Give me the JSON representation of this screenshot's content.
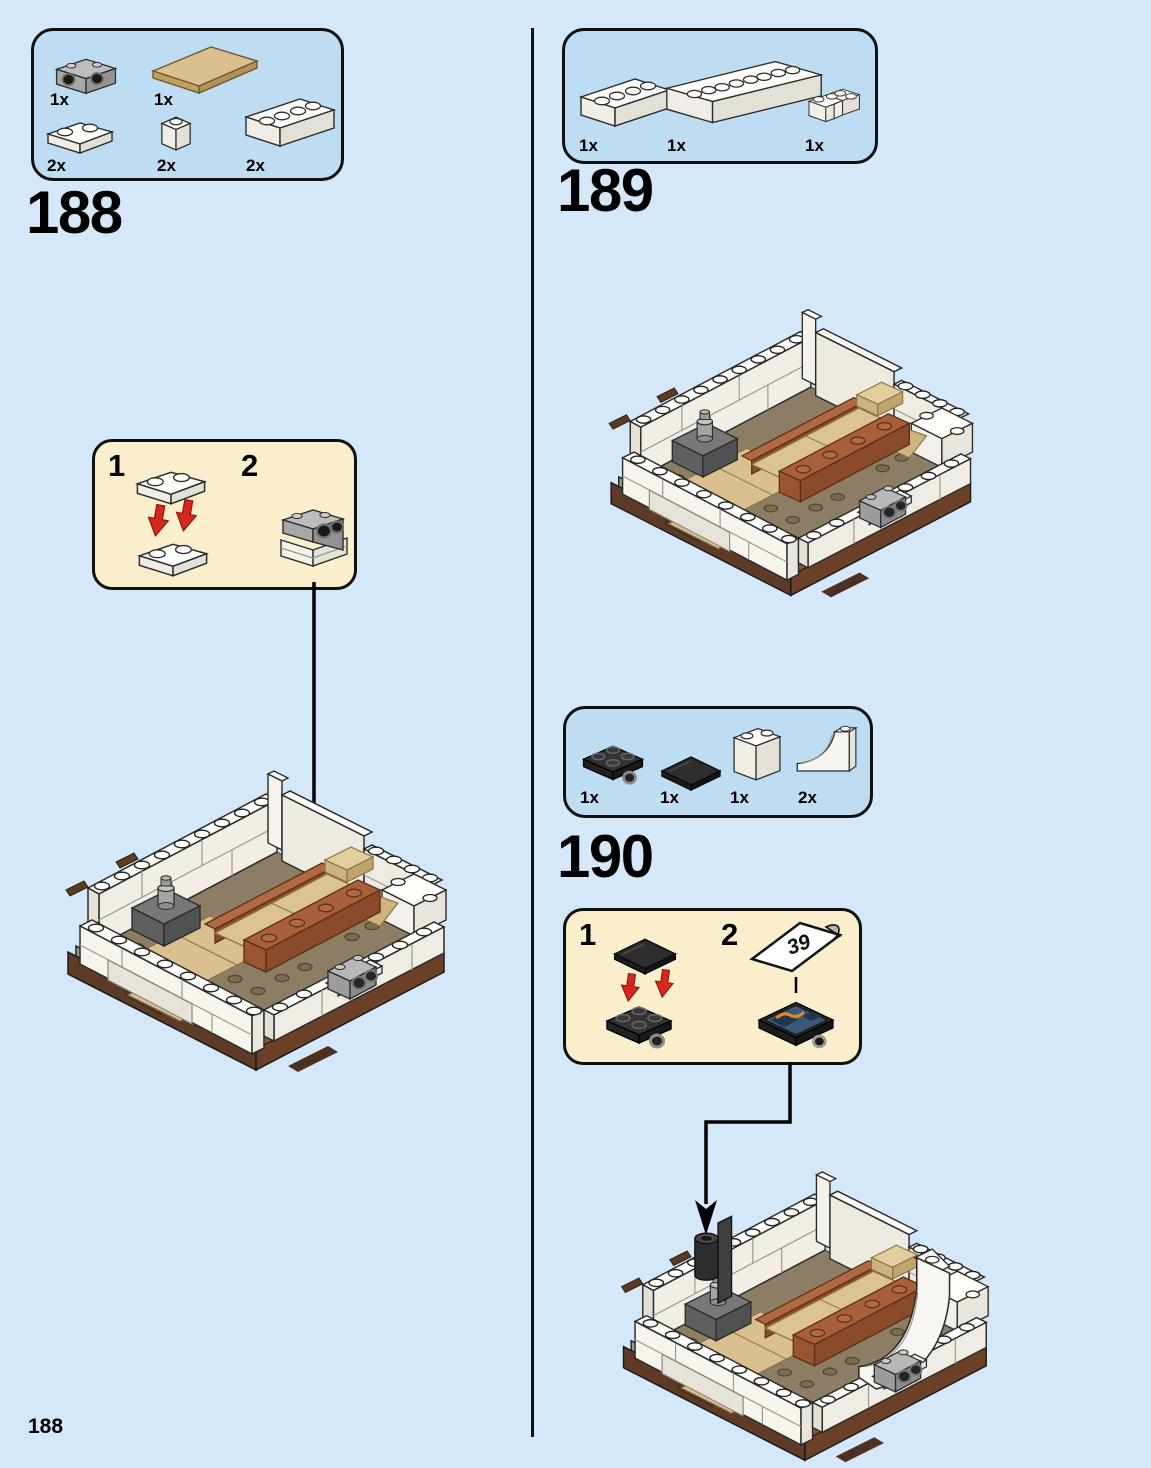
{
  "page": {
    "number": "188",
    "background": "#d4e8f9"
  },
  "colors": {
    "parts_box_fill": "#bedcf2",
    "callout_fill": "#faeecd",
    "outline_black": "#101010",
    "arrow_red": "#d6281e",
    "brick_white": "#fdfdfa",
    "tan": "#d9c08e",
    "rust": "#a9603a",
    "base_brown": "#5d3b26",
    "floor_taupe": "#8d7d64",
    "gray_part": "#9c9c9c",
    "black_part": "#2e2e2e"
  },
  "step188": {
    "heading": "188",
    "parts": [
      {
        "qty": "1x",
        "name": "gray brick 1x2 with drum holes"
      },
      {
        "qty": "1x",
        "name": "tan plate 4x6"
      },
      {
        "qty": "2x",
        "name": "white plate 1x2"
      },
      {
        "qty": "2x",
        "name": "white brick 1x1"
      },
      {
        "qty": "2x",
        "name": "white brick 1x4"
      }
    ],
    "callout": {
      "step1": "1",
      "step2": "2"
    }
  },
  "step189": {
    "heading": "189",
    "parts": [
      {
        "qty": "1x",
        "name": "white brick 1x4"
      },
      {
        "qty": "1x",
        "name": "white brick 1x8"
      },
      {
        "qty": "1x",
        "name": "white corner brick 2x2"
      }
    ]
  },
  "step190": {
    "heading": "190",
    "parts": [
      {
        "qty": "1x",
        "name": "black turntable plate 2x2"
      },
      {
        "qty": "1x",
        "name": "black tile 2x2"
      },
      {
        "qty": "1x",
        "name": "white brick 1x2x2"
      },
      {
        "qty": "2x",
        "name": "white inverted arch brick"
      }
    ],
    "callout": {
      "step1": "1",
      "step2": "2",
      "sticker_number": "39"
    }
  }
}
